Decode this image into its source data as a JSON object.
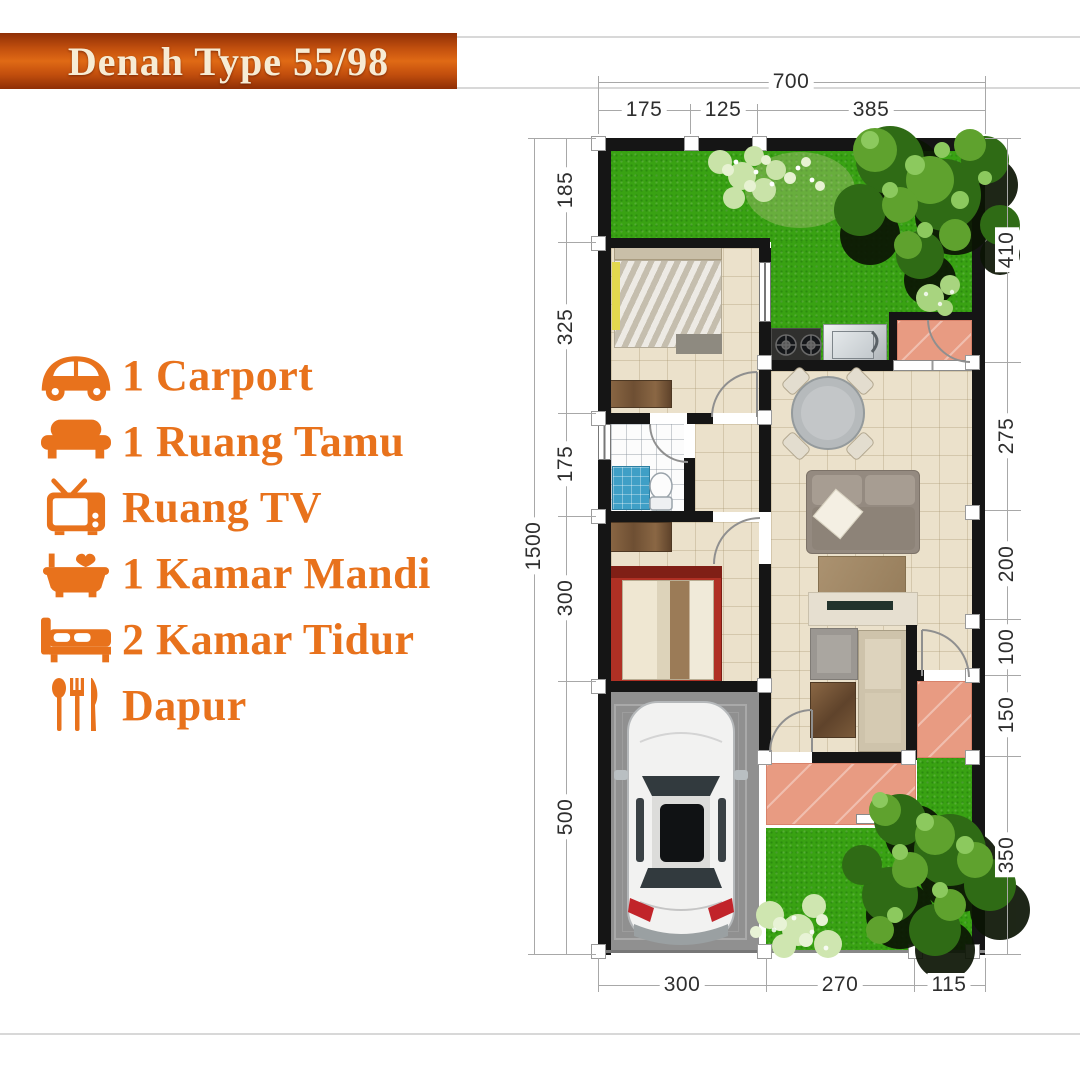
{
  "banner": {
    "title": "Denah Type 55/98",
    "bg_color": "#c3500e",
    "text_color": "#f7ecd4"
  },
  "features": [
    {
      "icon": "car-icon",
      "label": "1 Carport"
    },
    {
      "icon": "sofa-icon",
      "label": "1 Ruang Tamu"
    },
    {
      "icon": "tv-icon",
      "label": "Ruang TV"
    },
    {
      "icon": "bathtub-icon",
      "label": "1 Kamar Mandi"
    },
    {
      "icon": "bed-icon",
      "label": "2 Kamar Tidur"
    },
    {
      "icon": "utensils-icon",
      "label": "Dapur"
    }
  ],
  "accent_color": "#e8721c",
  "plan": {
    "dims": {
      "top_total": "700",
      "top": [
        "175",
        "125",
        "385"
      ],
      "left_total": "1500",
      "left": [
        "185",
        "325",
        "175",
        "300",
        "500"
      ],
      "right": [
        "410",
        "275",
        "200",
        "100",
        "150",
        "350"
      ],
      "bottom": [
        "300",
        "270",
        "115"
      ]
    },
    "colors": {
      "grass": "#39a213",
      "floor": "#ebe1cb",
      "terrace": "#e89b82",
      "carport": "#909090",
      "wall": "#151515"
    }
  }
}
